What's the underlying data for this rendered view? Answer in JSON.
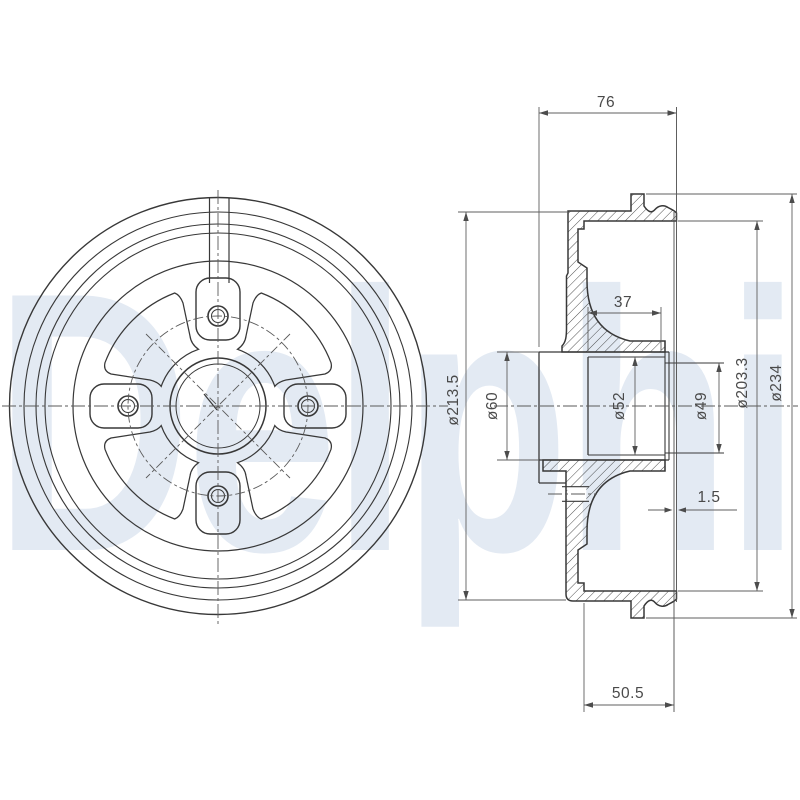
{
  "watermark": {
    "text": "Delphi"
  },
  "dimensions": {
    "overall_width": "76",
    "hub_protrusion": "37",
    "lip_gap": "1.5",
    "drum_depth": "50.5",
    "outer_diameter": "ø213.5",
    "hub_outer_diameter": "ø60",
    "bore_diameter": "ø52",
    "pilot_bore_diameter": "ø49",
    "braking_surface_diameter": "ø203.3",
    "flange_diameter": "ø234"
  }
}
